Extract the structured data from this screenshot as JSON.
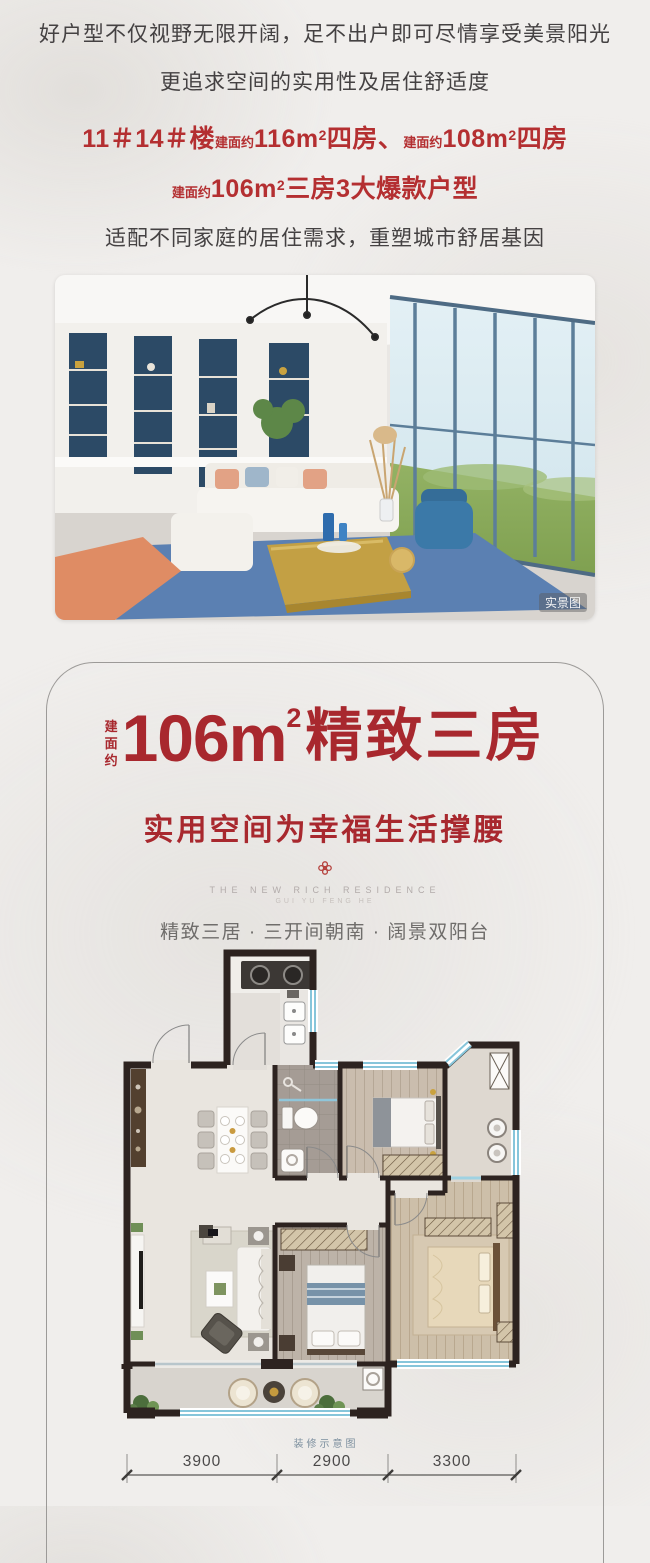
{
  "colors": {
    "accent_red": "#b42f31",
    "title_red": "#a8282e",
    "text_dark": "#444142",
    "wall_dark": "#2d2320",
    "window_blue": "#86c5da",
    "tagline_gray": "#6f6d6b"
  },
  "intro": {
    "line1": "好户型不仅视野无限开阔，足不出户即可尽情享受美景阳光",
    "line2": "更追求空间的实用性及居住舒适度",
    "line3": {
      "building": "11＃14＃楼",
      "area_label1": "建面约",
      "area_value1": "116m",
      "sup1": "2",
      "suffix1": "四房、",
      "area_label2": "建面约",
      "area_value2": "108m",
      "sup2": "2",
      "suffix2": "四房"
    },
    "line4": {
      "area_label": "建面约",
      "area_value": "106m",
      "sup": "2",
      "suffix": "三房3大爆款户型"
    },
    "line5": "适配不同家庭的居住需求，重塑城市舒居基因"
  },
  "photo": {
    "watermark": "实景图"
  },
  "card": {
    "area_label": "建面约",
    "area_value": "106m",
    "area_sup": "2",
    "title": "精致三房",
    "subtitle": "实用空间为幸福生活撑腰",
    "logo_line1": "THE NEW RICH RESIDENCE",
    "logo_line2": "GUI YU FENG HE",
    "tagline": "精致三居 · 三开间朝南 · 阔景双阳台"
  },
  "floorplan": {
    "caption": "装修示意图",
    "dims": [
      "3900",
      "2900",
      "3300"
    ]
  }
}
